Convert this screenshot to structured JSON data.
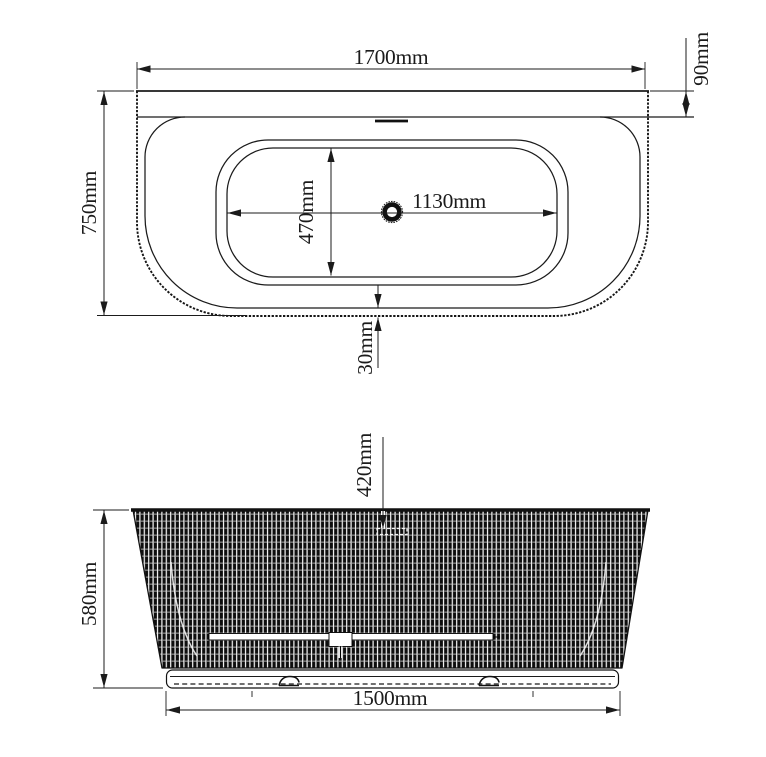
{
  "drawing": {
    "top_view": {
      "overall_width": "1700mm",
      "overall_depth": "750mm",
      "back_deck_width": "90mm",
      "basin_length": "1130mm",
      "basin_width": "470mm",
      "front_deck_width": "30mm"
    },
    "front_view": {
      "height": "580mm",
      "drain_drop": "420mm",
      "base_width": "1500mm"
    },
    "colors": {
      "line": "#1b1b1b",
      "background": "#ffffff",
      "flute_dark": "#0e0e0e",
      "flute_light": "#fafafa"
    }
  }
}
